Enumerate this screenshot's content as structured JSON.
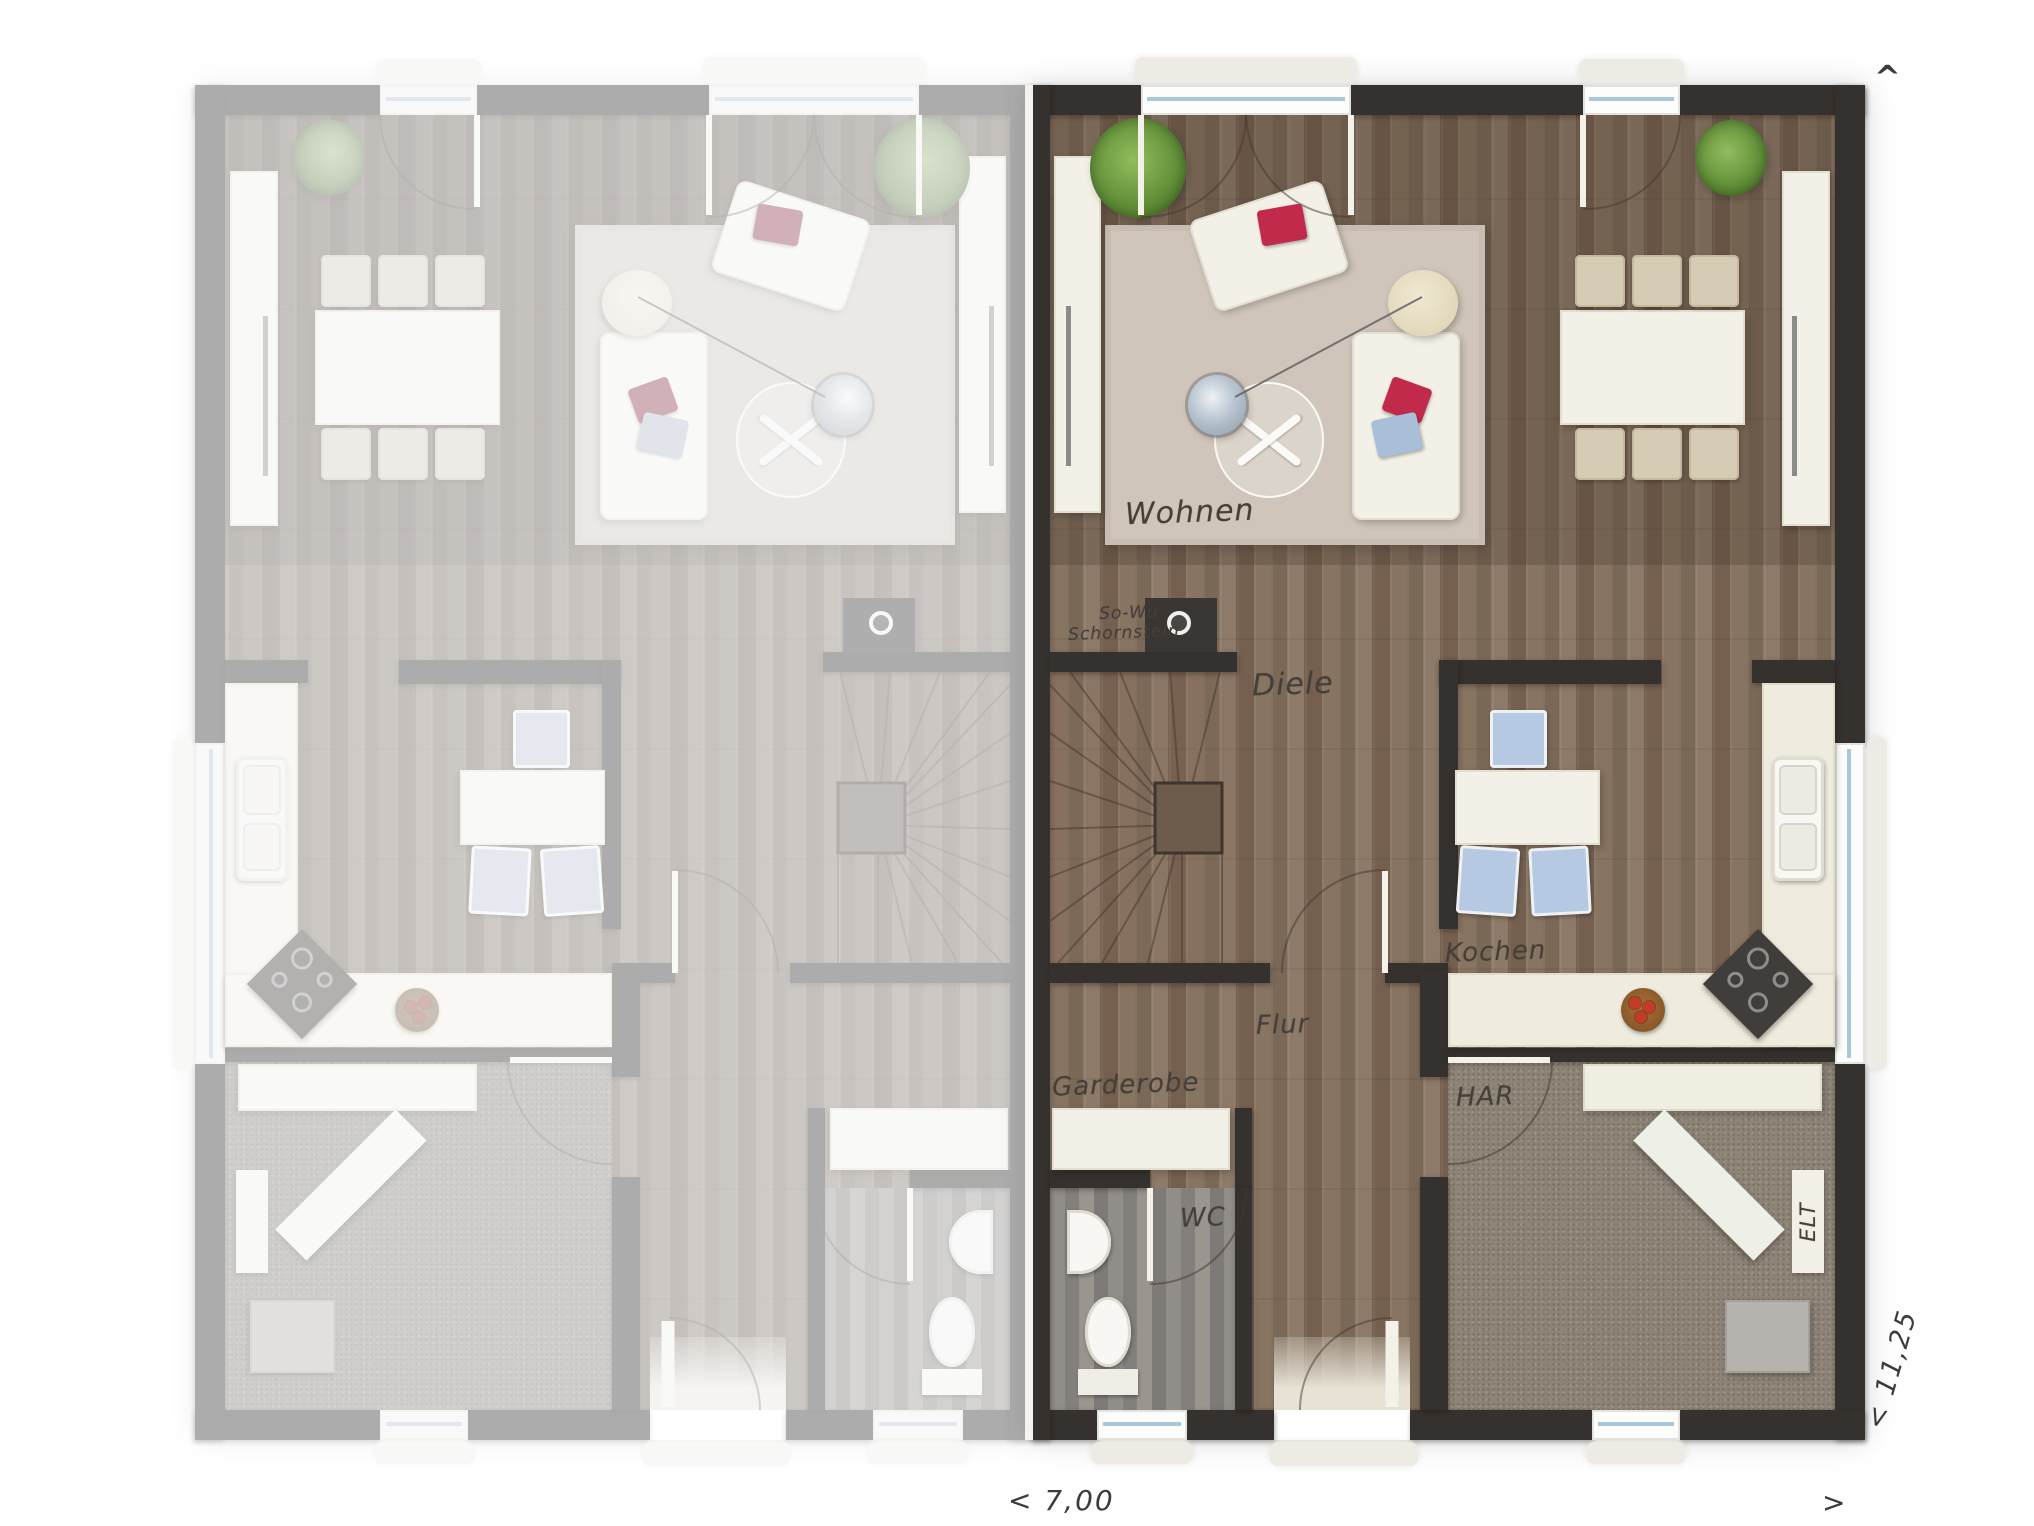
{
  "labels": {
    "wohnen": "Wohnen",
    "schornstein_line1": "So-Wu",
    "schornstein_line2": "Schornstein",
    "diele": "Diele",
    "kochen": "Kochen",
    "flur": "Flur",
    "garderobe": "Garderobe",
    "wc": "WC",
    "har": "HAR",
    "elt": "ELT"
  },
  "dimensions": {
    "width_label": "< 7,00",
    "width_arrow": ">",
    "depth_label": "< 11,25",
    "depth_arrow": "^"
  },
  "colors": {
    "wall": "#35312e",
    "wood_floor": "#83705f",
    "rug": "#cfc5ba",
    "accent_red": "#c12a4a",
    "accent_blue": "#a9bfd8",
    "plant_green": "#63913a",
    "counter": "#efecdf",
    "utility_floor": "#8d8376",
    "wc_floor": "#8c8885"
  }
}
